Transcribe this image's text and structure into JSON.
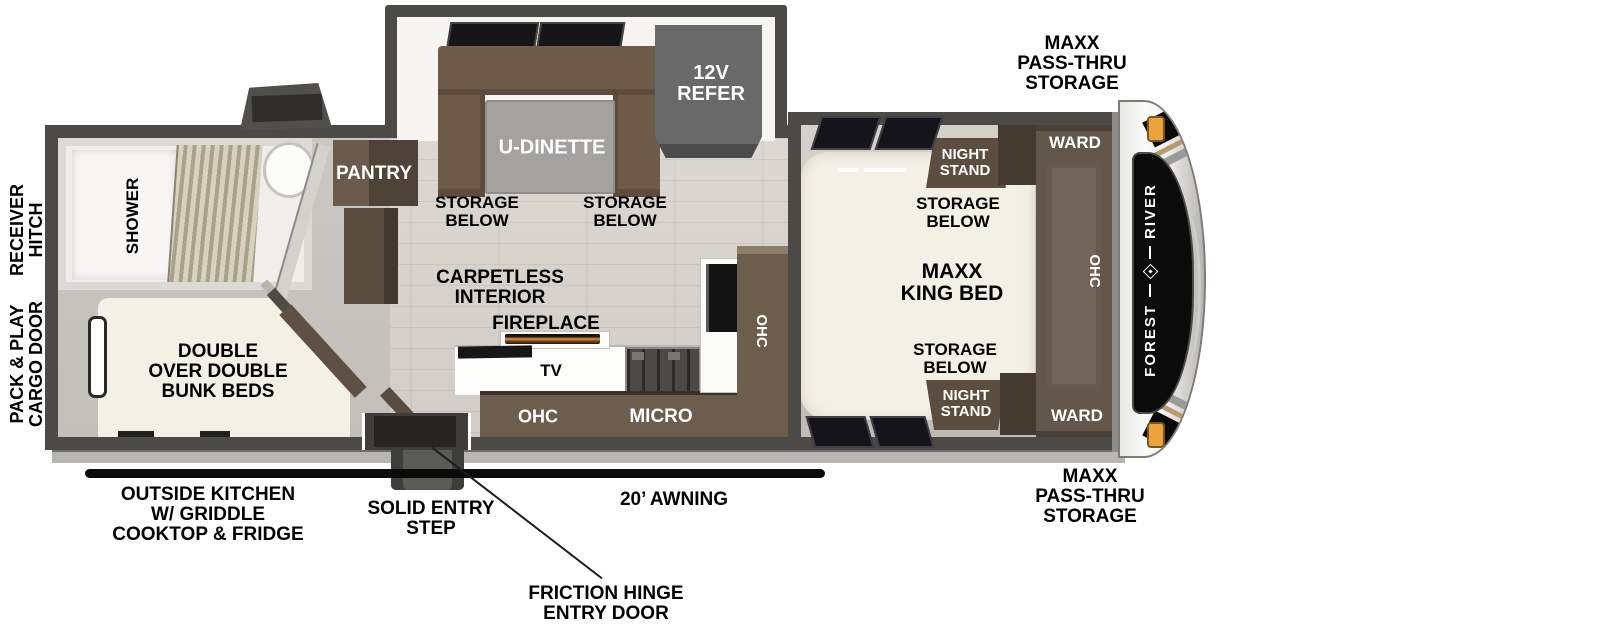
{
  "diagram_type": "rv-floorplan-top-view",
  "brand": {
    "word1": "FOREST",
    "word2": "RIVER"
  },
  "colors": {
    "wall": "#4b4a46",
    "cabinet_brown": "#6d5d4d",
    "cabinet_dark_brown": "#4f4337",
    "bed_cream": "#f3f0e6",
    "floor_wood": "#d6d2cb",
    "window_glass": "#15151a",
    "marker_light_orange": "#e9a43e",
    "flame_orange": "#e2913e",
    "annotation_text": "#000000"
  },
  "labels": {
    "maxx_pass_thru_storage": "MAXX\nPASS-THRU\nSTORAGE",
    "receiver_hitch": "RECEIVER\nHITCH",
    "pack_play_cargo_door": "PACK & PLAY\nCARGO DOOR",
    "shower": "SHOWER",
    "pantry": "PANTRY",
    "u_dinette": "U-DINETTE",
    "refer_12v": "12V\nREFER",
    "storage_below": "STORAGE\nBELOW",
    "night_stand": "NIGHT\nSTAND",
    "ward": "WARD",
    "ohc": "OHC",
    "maxx_king_bed": "MAXX\nKING BED",
    "carpetless_interior": "CARPETLESS\nINTERIOR",
    "fireplace": "FIREPLACE",
    "tv": "TV",
    "micro": "MICRO",
    "double_bunk_beds": "DOUBLE\nOVER DOUBLE\nBUNK BEDS",
    "outside_kitchen": "OUTSIDE KITCHEN\nW/ GRIDDLE\nCOOKTOP & FRIDGE",
    "solid_entry_step": "SOLID ENTRY\nSTEP",
    "awning": "20’ AWNING",
    "friction_hinge_entry_door": "FRICTION HINGE\nENTRY DOOR"
  }
}
